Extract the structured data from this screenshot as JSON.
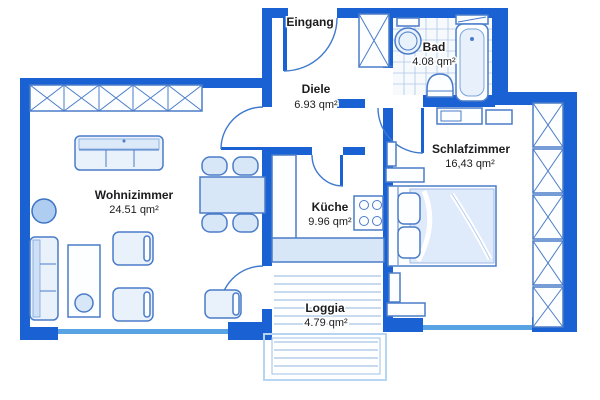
{
  "rooms": {
    "eingang": {
      "label": "Eingang"
    },
    "diele": {
      "name": "Diele",
      "area": "6.93 qm²"
    },
    "bad": {
      "name": "Bad",
      "area": "4.08 qm²"
    },
    "schlafzimmer": {
      "name": "Schlafzimmer",
      "area": "16,43 qm²"
    },
    "kueche": {
      "name": "Küche",
      "area": "9.96 qm²"
    },
    "wohnzimmer": {
      "name": "Wohnizimmer",
      "area": "24.51 qm²"
    },
    "loggia": {
      "name": "Loggia",
      "area": "4.79 qm²"
    }
  },
  "colors": {
    "wall": "#1a62d4",
    "outline": "#4a7cc9",
    "fill": "#e9f1fb",
    "window": "#57a3e3",
    "plank": "#8fb4e2",
    "text": "#1c1c1e"
  }
}
